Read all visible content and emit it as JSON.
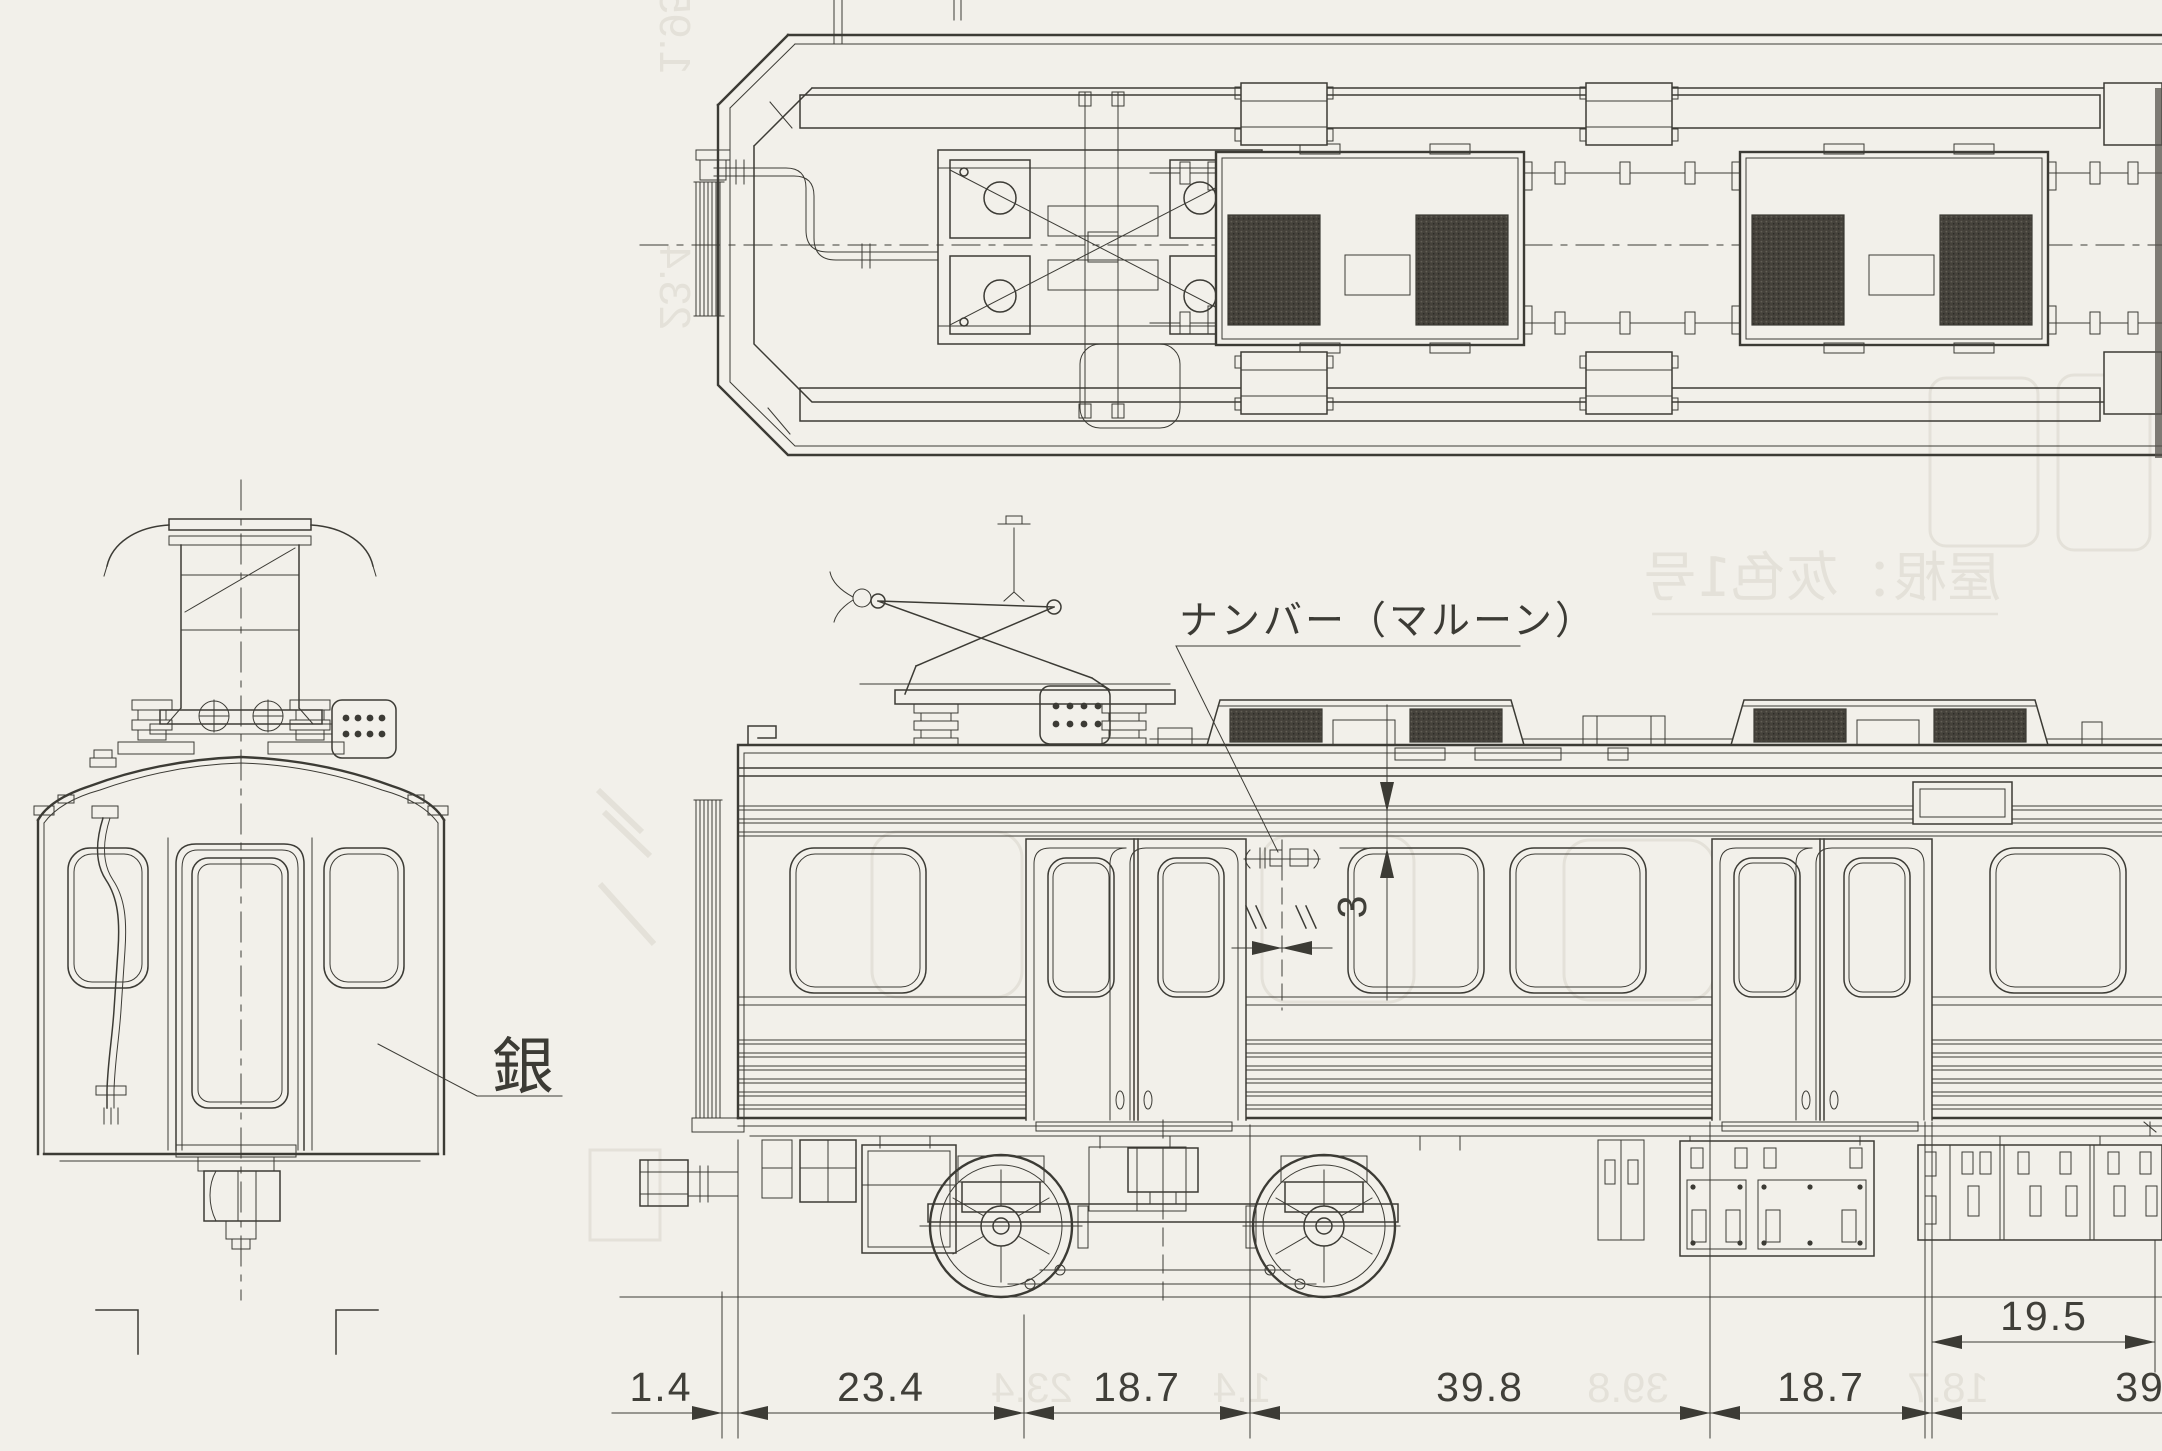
{
  "annotations": {
    "number_plate_label": "ナンバー（マルーン）",
    "silver_label": "銀"
  },
  "dimensions": {
    "bottom_row": [
      "1.4",
      "23.4",
      "18.7",
      "39.8",
      "18.7",
      "39"
    ],
    "door_offset": "19.5",
    "beading_to_window": "3",
    "ditto_marks": "〃 〃"
  },
  "ghost_bleedthrough": {
    "roof_color_note": "屋根：灰色1号",
    "numbers": [
      "23.4",
      "1.4",
      "39.8",
      "18.7",
      "1.95",
      "23.4"
    ]
  },
  "colors": {
    "paper": "#f2f0ea",
    "ink": "#3c3b35",
    "hatch_dark": "#45423b",
    "ghost": "#d9d6cb"
  }
}
